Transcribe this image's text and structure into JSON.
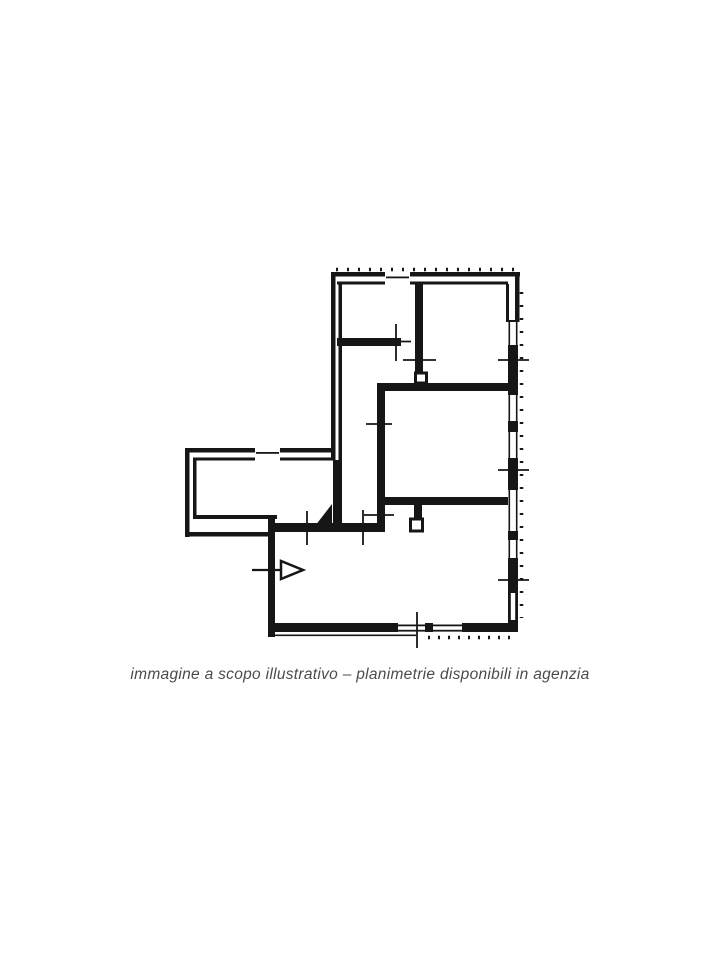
{
  "page": {
    "background_color": "#ffffff"
  },
  "caption": {
    "text": "immagine a scopo illustrativo – planimetrie disponibili in agenzia",
    "color": "#4b4b4b"
  },
  "plan": {
    "kind": "apartment-floor-plan-scan",
    "ink_color": "#161616",
    "symbols": {
      "entrance_arrow": "right-pointing-arrow",
      "dimension_marks": "plus-tick-crosses",
      "windows": "double-line-wall-slots"
    }
  }
}
